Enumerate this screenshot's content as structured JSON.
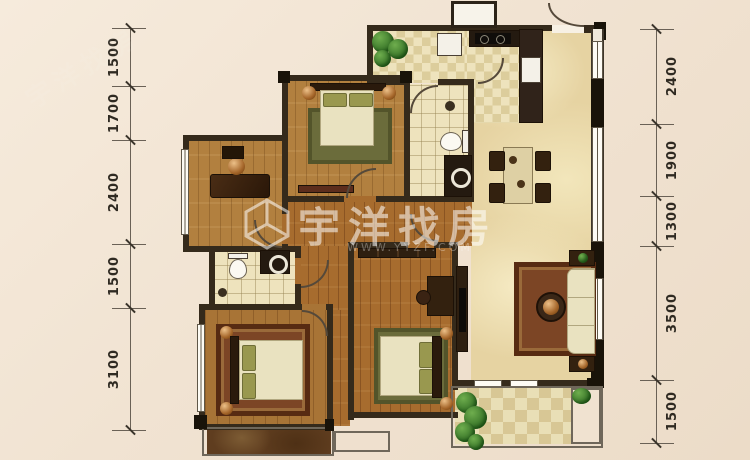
{
  "watermark": {
    "brand": "宇洋找房",
    "url": "WWW.YYZF.COM",
    "logo": "hexagon-cube-logo"
  },
  "dimensions": {
    "left": [
      "1500",
      "1700",
      "2400",
      "1500",
      "3100"
    ],
    "right": [
      "2400",
      "1900",
      "1300",
      "3500",
      "1500"
    ]
  },
  "palette": {
    "background": "#f1e3d2",
    "wall": "#352a1b",
    "wood": "#b2803f",
    "wood_dark": "#a76c2e",
    "tile": "#eee3bd",
    "marble": "#e6d3a2",
    "rug_green": "#6b6c3b",
    "rug_red": "#7c4525",
    "copper": "#a5662a",
    "plant_green": "#2f6b22",
    "cream": "#e9e2c0"
  }
}
